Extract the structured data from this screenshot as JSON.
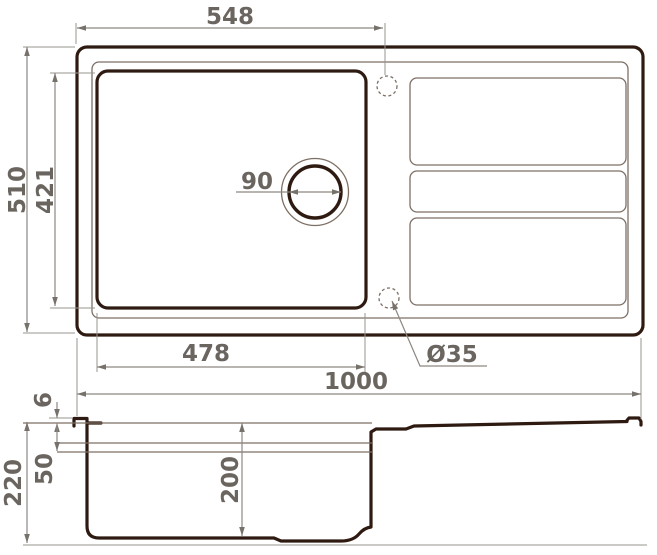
{
  "drawing": {
    "title": "kitchen-sink-dimension-drawing",
    "units": "mm",
    "dims": {
      "top_width": "548",
      "overall_length": "1000",
      "overall_width": "510",
      "bowl_width_inner": "421",
      "bowl_length_inner": "478",
      "drain_diameter": "90",
      "tap_hole_diameter": "Ø35",
      "rim_height": "6",
      "total_depth": "220",
      "ledge_depth": "50",
      "bowl_depth": "200"
    },
    "colors": {
      "outline": "#2e1a10",
      "thin_line": "#7d6f65",
      "dimension_line": "#8d8781",
      "dimension_text": "#6b6560",
      "background": "#ffffff"
    }
  }
}
